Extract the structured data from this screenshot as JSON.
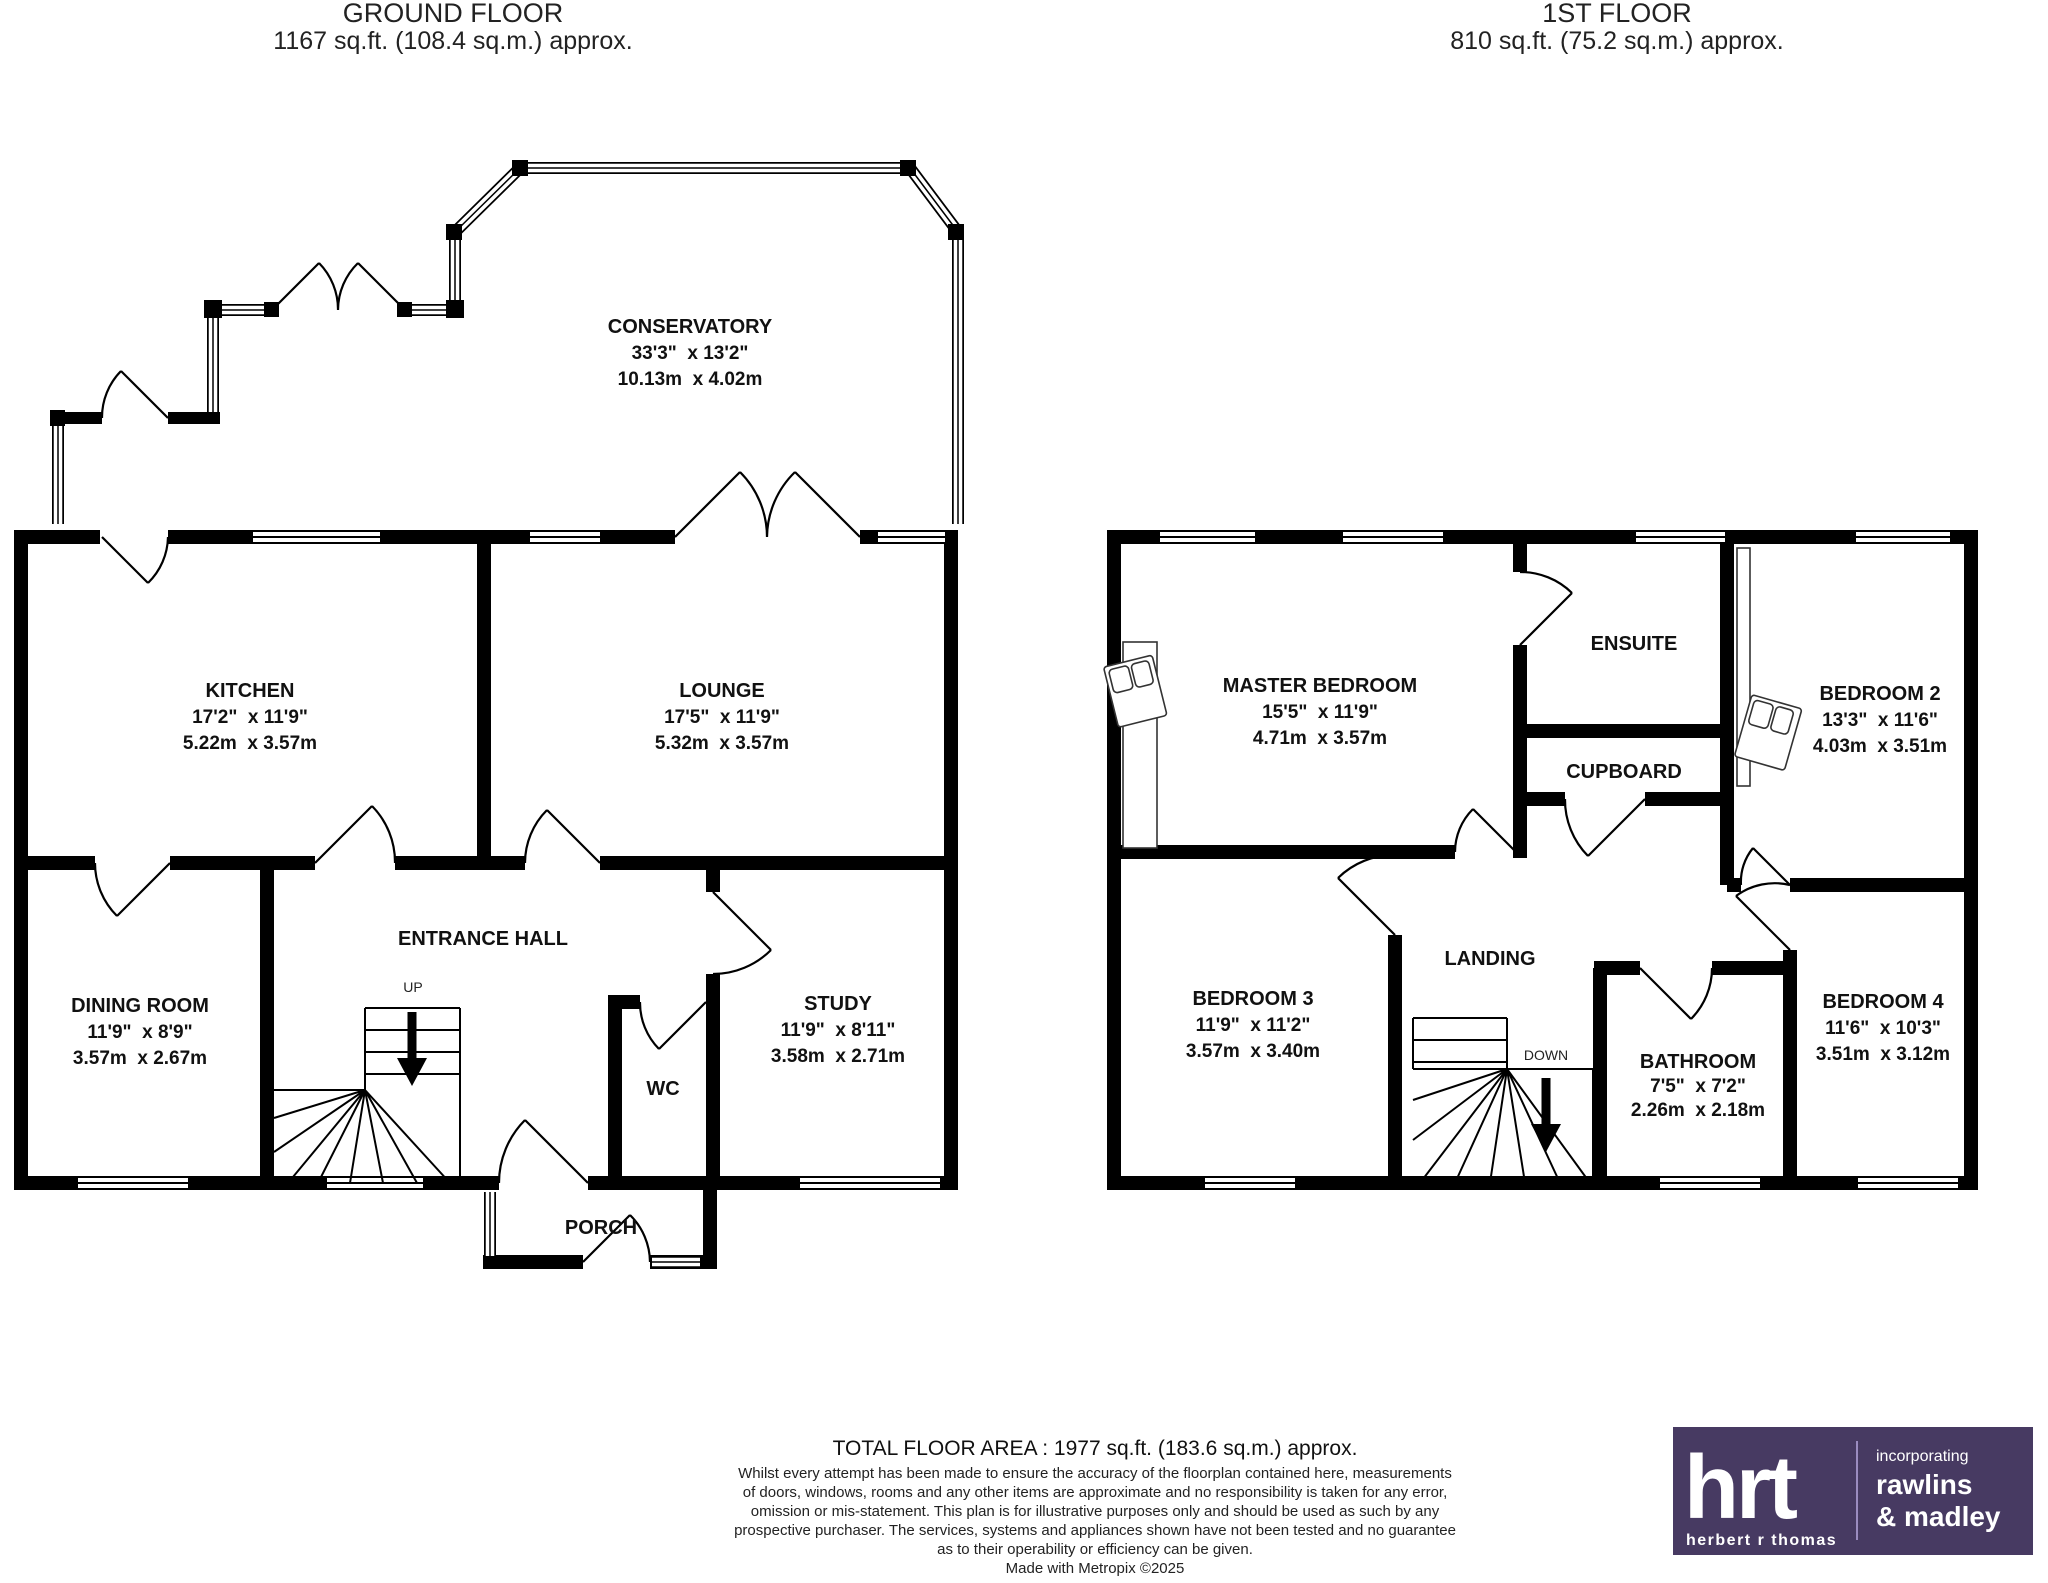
{
  "ground": {
    "title": "GROUND FLOOR",
    "area": "1167 sq.ft. (108.4 sq.m.) approx.",
    "stair_label": "UP",
    "rooms": {
      "conservatory": {
        "name": "CONSERVATORY",
        "imperial": "33'3\"  x 13'2\"",
        "metric": "10.13m  x 4.02m"
      },
      "kitchen": {
        "name": "KITCHEN",
        "imperial": "17'2\"  x 11'9\"",
        "metric": "5.22m  x 3.57m"
      },
      "lounge": {
        "name": "LOUNGE",
        "imperial": "17'5\"  x 11'9\"",
        "metric": "5.32m  x 3.57m"
      },
      "dining_room": {
        "name": "DINING ROOM",
        "imperial": "11'9\"  x 8'9\"",
        "metric": "3.57m  x 2.67m"
      },
      "entrance_hall": {
        "name": "ENTRANCE HALL"
      },
      "study": {
        "name": "STUDY",
        "imperial": "11'9\"  x 8'11\"",
        "metric": "3.58m  x 2.71m"
      },
      "wc": {
        "name": "WC"
      },
      "porch": {
        "name": "PORCH"
      }
    }
  },
  "first": {
    "title": "1ST FLOOR",
    "area": "810 sq.ft. (75.2 sq.m.) approx.",
    "stair_label": "DOWN",
    "rooms": {
      "master_bedroom": {
        "name": "MASTER BEDROOM",
        "imperial": "15'5\"  x 11'9\"",
        "metric": "4.71m  x 3.57m"
      },
      "ensuite": {
        "name": "ENSUITE"
      },
      "cupboard": {
        "name": "CUPBOARD"
      },
      "bedroom2": {
        "name": "BEDROOM 2",
        "imperial": "13'3\"  x 11'6\"",
        "metric": "4.03m  x 3.51m"
      },
      "bedroom3": {
        "name": "BEDROOM 3",
        "imperial": "11'9\"  x 11'2\"",
        "metric": "3.57m  x 3.40m"
      },
      "landing": {
        "name": "LANDING"
      },
      "bathroom": {
        "name": "BATHROOM",
        "imperial": "7'5\"  x 7'2\"",
        "metric": "2.26m  x 2.18m"
      },
      "bedroom4": {
        "name": "BEDROOM 4",
        "imperial": "11'6\"  x 10'3\"",
        "metric": "3.51m  x 3.12m"
      }
    }
  },
  "footer": {
    "total_area": "TOTAL FLOOR AREA : 1977 sq.ft. (183.6 sq.m.) approx.",
    "disclaimer_lines": [
      "Whilst every attempt has been made to ensure the accuracy of the floorplan contained here, measurements",
      "of doors, windows, rooms and any other items are approximate and no responsibility is taken for any error,",
      "omission or mis-statement. This plan is for illustrative purposes only and should be used as such by any",
      "prospective purchaser. The services, systems and appliances shown have not been tested and no guarantee",
      "as to their operability or efficiency can be given."
    ],
    "credit": "Made with Metropix ©2025"
  },
  "logo": {
    "brand": "hrt",
    "tagline": "herbert r thomas",
    "incorporating": "incorporating",
    "partner_line1": "rawlins",
    "partner_line2": "& madley",
    "bg_color": "#473A62",
    "divider_color": "#9b8cc0"
  }
}
